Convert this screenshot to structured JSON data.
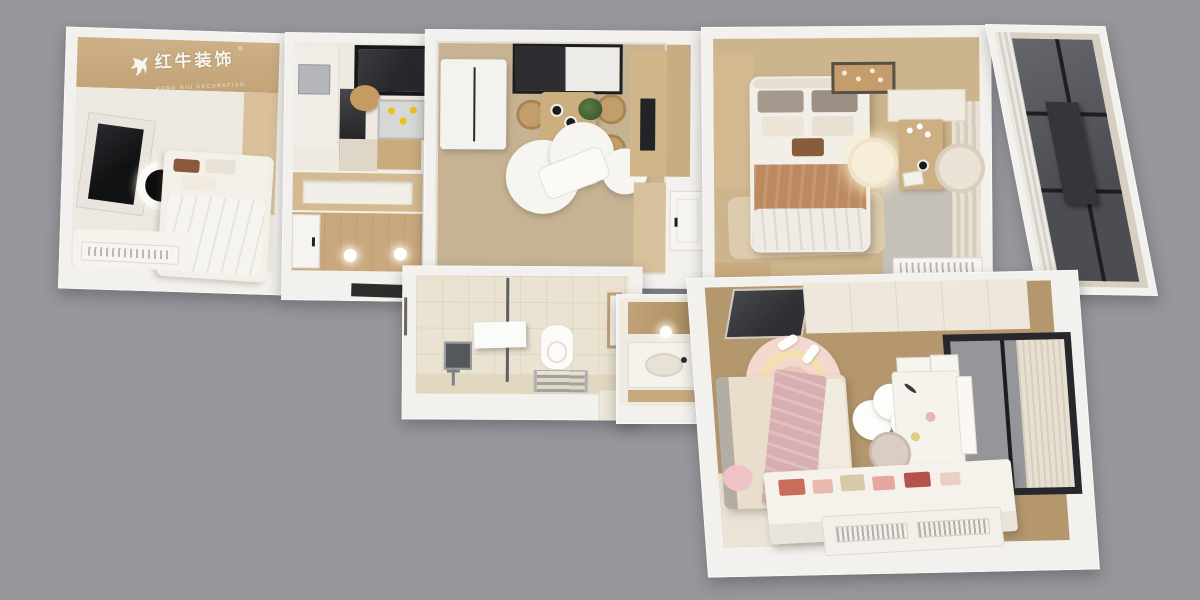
{
  "meta": {
    "description": "3D rendered top-down axonometric floor plan of an apartment",
    "background_color": "#97969b",
    "wall_color": "#f3f1ed"
  },
  "watermark": {
    "brand_cn": "红牛装饰",
    "registered_mark": "®",
    "brand_en": "HONG NIU DECORATION",
    "color": "#f7f5ef"
  },
  "rooms": [
    {
      "name": "secondary-bedroom",
      "position": "top-left",
      "floor_color": "#eee9e0",
      "furniture": [
        "wall-tv",
        "round-ceiling-lamp",
        "bed",
        "wardrobe",
        "rug",
        "radiator"
      ]
    },
    {
      "name": "kitchen",
      "position": "top-center-left",
      "floor_color": "#efeae1",
      "furniture": [
        "window",
        "wall-cabinets",
        "tall-appliance",
        "cutting-board",
        "sink-with-dishes",
        "wood-counter"
      ]
    },
    {
      "name": "entry-hall",
      "position": "center-left",
      "floor_color": "#c9a87d",
      "furniture": [
        "entry-door",
        "recessed-shelf",
        "ceiling-spotlights"
      ]
    },
    {
      "name": "dining-room",
      "position": "top-center",
      "floor_color": "#c5b394",
      "furniture": [
        "refrigerator",
        "pass-through-window",
        "dining-table",
        "plant",
        "dining-chairs",
        "cloud-rug",
        "lounge-seat",
        "tall-cabinet",
        "tv-niche",
        "interior-door"
      ]
    },
    {
      "name": "master-bedroom",
      "position": "top-right",
      "floor_color": "#ccb48c",
      "furniture": [
        "wardrobe",
        "double-bed",
        "decorative-ceiling-lamp",
        "round-pendant-lamp",
        "vanity-desk",
        "flowers",
        "armchair",
        "wall-cabinet",
        "sheer-curtain",
        "area-rug",
        "radiator"
      ]
    },
    {
      "name": "balcony",
      "position": "far-right",
      "floor_color": "#56585e",
      "furniture": [
        "floor-to-ceiling-glazing",
        "dark-panel",
        "curtain"
      ]
    },
    {
      "name": "bathroom",
      "position": "bottom-center",
      "floor_color": "#ebe3d2",
      "furniture": [
        "shower-glass-partition",
        "shower-screen",
        "vanity-mirror",
        "faucet",
        "toilet",
        "towel-radiator",
        "window",
        "step"
      ]
    },
    {
      "name": "wash-basin-nook",
      "position": "bottom-center-right",
      "floor_color": "#f0ebe1",
      "furniture": [
        "mirror-cabinet",
        "wall-light",
        "basin-counter"
      ]
    },
    {
      "name": "kids-bedroom",
      "position": "bottom-right",
      "floor_color": "#b5976e",
      "furniture": [
        "smoked-glass-wardrobe",
        "storage-cabinet",
        "window-with-curtain",
        "bed",
        "pink-blanket",
        "whale-plush",
        "round-rainbow-rug",
        "slippers",
        "cloud-mirror",
        "desk",
        "pegboard",
        "storage-boxes",
        "chair",
        "toy-bench",
        "radiator-unit"
      ]
    }
  ]
}
